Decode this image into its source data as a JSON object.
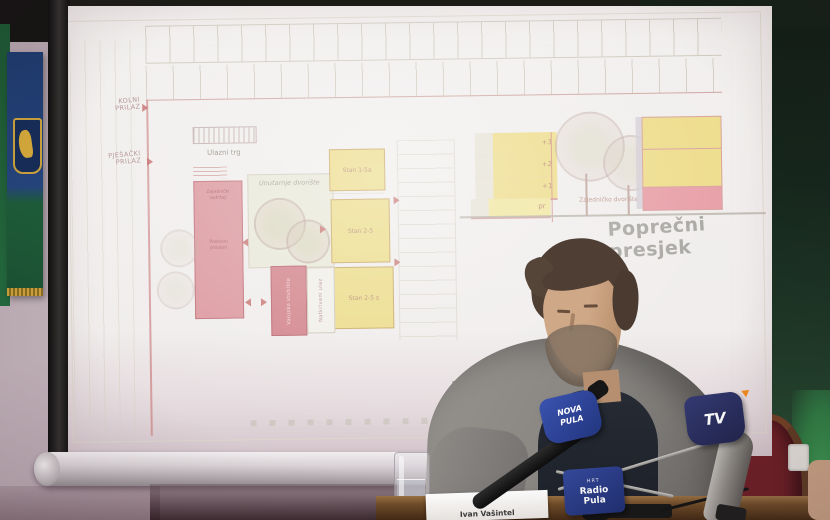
{
  "scene": {
    "description": "Press conference photo: speaker at table with microphones in front of projected architectural drawings"
  },
  "projection": {
    "floor_plan": {
      "access_vehicle": {
        "line1": "KOLNI",
        "line2": "PRILAZ"
      },
      "access_pedestrian": {
        "line1": "PJEŠAČKI",
        "line2": "PRILAZ"
      },
      "entrance_square": "Ulazni trg",
      "courtyard": {
        "line1": "Unutarnje",
        "line2": "dvorište"
      },
      "apartments": [
        "Stan 1-5a",
        "Stan 2-5",
        "Stan 2-5 s"
      ],
      "red_block": {
        "group1a": "Zajednički",
        "group1b": "sadržaji",
        "group2a": "Poslovni",
        "group2b": "prostori"
      },
      "red_vertical": "Vanjsko stubište",
      "white_vertical": "Natkriveni ulaz",
      "caption": "Tlocrt prizemlja"
    },
    "cross_section": {
      "floors": [
        "+3",
        "+2",
        "+1",
        "pr"
      ],
      "courtyard": "Zajedničko dvorište",
      "caption": "Poprečni presjek"
    }
  },
  "microphones": {
    "nova": {
      "line1": "NOVA",
      "line2": "PULA"
    },
    "radio": {
      "station": "HRT",
      "line1": "Radio",
      "line2": "Pula"
    },
    "tv": {
      "logo": "TV"
    }
  },
  "table": {
    "name_plate": "Ivan Vašintel"
  },
  "colors": {
    "plan_red": "#dc9aa0",
    "plan_yellow": "#ecdc8a",
    "caption_grey": "#a3a19c",
    "mic_flag_blue": "#2b3f8c",
    "tv_accent_orange": "#f08a1e",
    "wall_green": "#2a5638",
    "chair_red": "#6e1f26",
    "istria_flag_blue": "#1d3a6d",
    "istria_flag_green": "#1d5c38"
  }
}
